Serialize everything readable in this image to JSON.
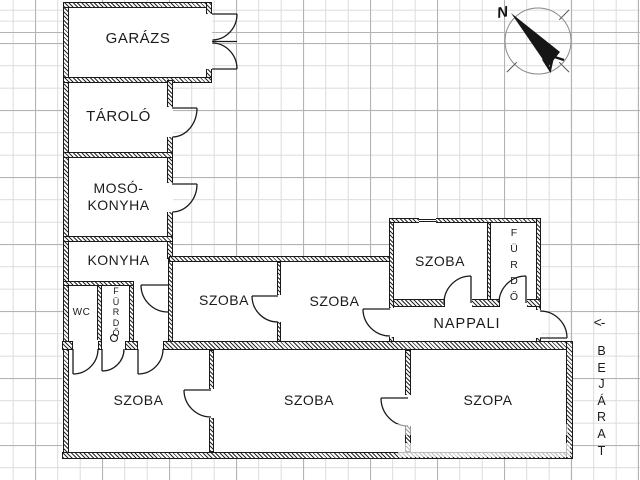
{
  "canvas": {
    "background": "#ffffff",
    "grid_minor_color": "#dcdcdc",
    "grid_major_color": "#b3b3b3",
    "line_color": "#1a1a1a"
  },
  "rooms": {
    "garazs": {
      "label": "GARÁZS"
    },
    "tarolo": {
      "label": "TÁROLÓ"
    },
    "moso_konyha": {
      "line1": "MOSÓ-",
      "line2": "KONYHA"
    },
    "konyha": {
      "label": "KONYHA"
    },
    "wc": {
      "label": "WC"
    },
    "furdo_small": {
      "label": "FÜRDŐ"
    },
    "szoba_mid_left": {
      "label": "SZOBA"
    },
    "szoba_mid_center": {
      "label": "SZOBA"
    },
    "szoba_top_right": {
      "label": "SZOBA"
    },
    "furdo_right": {
      "label": "FÜRDŐ"
    },
    "nappali": {
      "label": "NAPPALI"
    },
    "szoba_bottom_left": {
      "label": "SZOBA"
    },
    "szoba_bottom_center": {
      "label": "SZOBA"
    },
    "szoba_bottom_right": {
      "label": "SZOPA"
    }
  },
  "annotations": {
    "entrance_label": "BEJÁRAT",
    "entrance_arrow": "<-",
    "compass_north": "N"
  }
}
